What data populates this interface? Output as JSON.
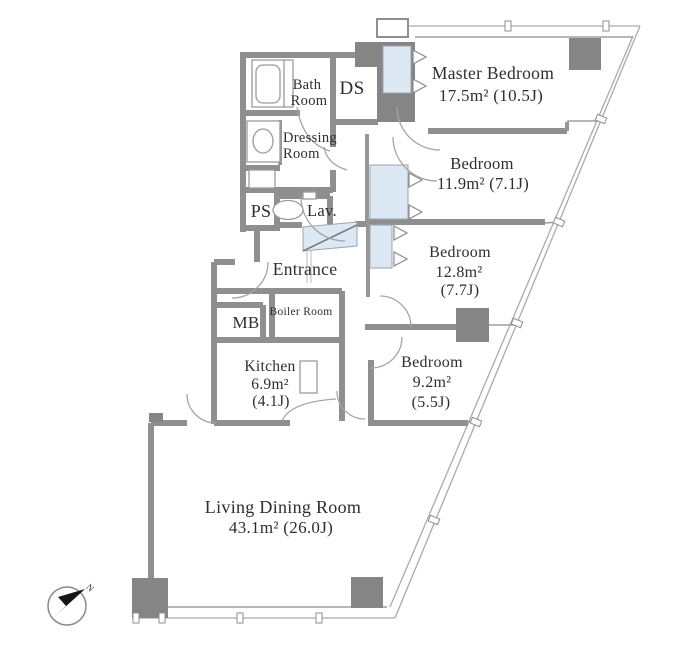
{
  "plan": {
    "rooms": {
      "master": {
        "name": "Master Bedroom",
        "area": "17.5m²  (10.5J)"
      },
      "bedroom2": {
        "name": "Bedroom",
        "area": "11.9m²  (7.1J)"
      },
      "bedroom3": {
        "name": "Bedroom",
        "area_m2": "12.8m²",
        "area_jo": "(7.7J)"
      },
      "bedroom4": {
        "name": "Bedroom",
        "area_m2": "9.2m²",
        "area_jo": "(5.5J)"
      },
      "kitchen": {
        "name": "Kitchen",
        "area_m2": "6.9m²",
        "area_jo": "(4.1J)"
      },
      "living": {
        "name": "Living Dining Room",
        "area": "43.1m²  (26.0J)"
      },
      "bath": {
        "line1": "Bath",
        "line2": "Room"
      },
      "dressing": {
        "line1": "Dressing",
        "line2": "Room"
      },
      "entrance": {
        "name": "Entrance"
      },
      "boiler": {
        "name": "Boiler Room"
      },
      "lav": {
        "name": "Lav."
      },
      "ds": {
        "name": "DS"
      },
      "ps": {
        "name": "PS"
      },
      "mb": {
        "name": "MB"
      }
    },
    "compass": {
      "north_label": "N"
    },
    "colors": {
      "wall": "#8f8f8f",
      "pillar": "#858585",
      "closet_blue": "#dce8f4"
    }
  }
}
